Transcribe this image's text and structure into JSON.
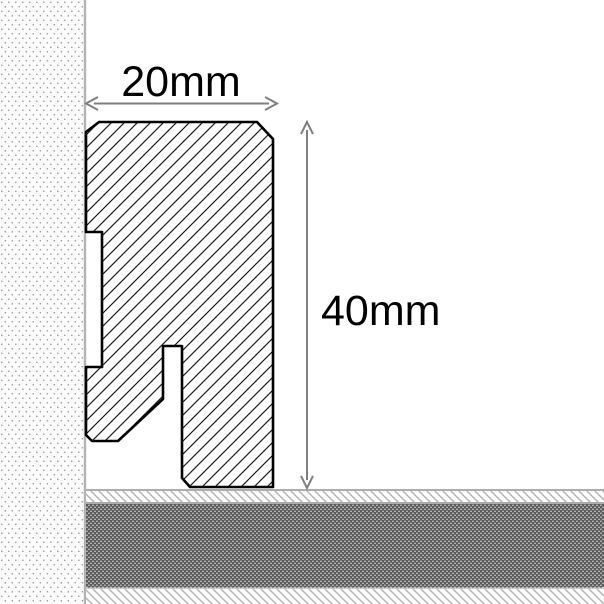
{
  "dimensions": {
    "width": {
      "label": "20mm",
      "value_mm": 20
    },
    "height": {
      "label": "40mm",
      "value_mm": 40
    }
  },
  "colors": {
    "dimension_line": "#7f7f7f",
    "label_text": "#000000",
    "profile_outline": "#000000",
    "profile_hatch": "#1c1c1c",
    "wall_edge": "#b3b3b3",
    "wall_dot": "#909090",
    "floor_border": "#adadad",
    "floor_hatch": "#b4b4b4",
    "floor_screed": "#5b5b5b"
  }
}
